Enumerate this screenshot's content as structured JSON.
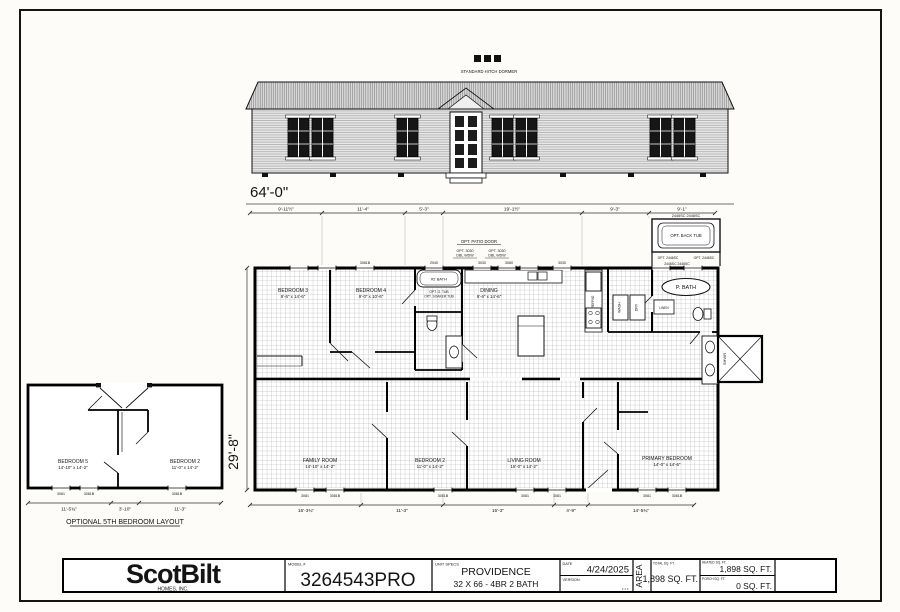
{
  "colors": {
    "paper": "#fdfcf8",
    "ink": "#141414",
    "grid": "#9f9f9f"
  },
  "elevation": {
    "dormer_caption": "STANDARD HITCH DORMER",
    "overall_width": "64'-0\""
  },
  "plan": {
    "overall_depth": "29'-8\"",
    "top_dims": [
      "9'-11½\"",
      "11'-4\"",
      "5'-3\"",
      "19'-1½\"",
      "9'-3\"",
      "9'-1\""
    ],
    "bottom_dims": [
      "15'-3¾\"",
      "11'-3\"",
      "15'-3\"",
      "4'-9\"",
      "14'-5¾\""
    ],
    "rooms": {
      "bedroom3": {
        "name": "BEDROOM 3",
        "size": "9'-6\" x 14'-6\""
      },
      "bedroom4": {
        "name": "BEDROOM 4",
        "size": "9'-0\" x 10'-6\""
      },
      "dining": {
        "name": "DINING",
        "size": "9'-6\" x 14'-6\""
      },
      "family": {
        "name": "FAMILY ROOM",
        "size": "14'-10\" x 14'-2\""
      },
      "bedroom2": {
        "name": "BEDROOM 2",
        "size": "11'-0\" x 14'-2\""
      },
      "living": {
        "name": "LIVING ROOM",
        "size": "15'-0\" x 14'-2\""
      },
      "primary": {
        "name": "PRIMARY BEDROOM",
        "size": "14'-0\" x 14'-6\""
      }
    },
    "fixtures": {
      "bath2": "#2 BATH",
      "opt_tub_1": "OPT. G. TUB",
      "opt_tub_2": "OPT. SOAKER TUB",
      "pbath": "P. BATH",
      "linen": "LINEN",
      "wash": "WASH",
      "dry": "DRY",
      "refrig": "REFRIG",
      "shower": "SHWR"
    },
    "options": {
      "patio_door": "OPT. PATIO DOOR",
      "dbl_wdw_1": "OPT. 3030",
      "dbl_wdw_2": "DBL WDW",
      "back_tub": "OPT. BACK TUB",
      "opt_2446": "OPT. 2446SC"
    },
    "tags": {
      "t2040": "2040",
      "t3030": "3030",
      "t3060": "3060",
      "t3081": "3081",
      "t3081b": "3081B",
      "t2446_pair": "2446SC   2446SC"
    }
  },
  "optional_layout": {
    "caption": "OPTIONAL 5TH BEDROOM LAYOUT",
    "dims": [
      "11'-5¾\"",
      "3'-10\"",
      "11'-3\""
    ],
    "bedroom5": {
      "name": "BEDROOM 5",
      "size": "14'-10\" x 14'-2\""
    },
    "bedroom2": {
      "name": "BEDROOM 2",
      "size": "11'-0\" x 14'-2\""
    }
  },
  "title_block": {
    "logo": "ScotBilt",
    "logo_sub": "HOMES, INC.",
    "model_label": "MODEL #",
    "model": "3264543PRO",
    "specs_label": "UNIT SPECS",
    "specs_line1": "PROVIDENCE",
    "specs_line2": "32 X 66 - 4BR 2 BATH",
    "date_label": "DATE",
    "date": "4/24/2025",
    "version_label": "VERSION",
    "version": "...",
    "area_label": "AREA",
    "total_label": "TOTAL SQ. FT.",
    "total": "1,898 SQ. FT.",
    "heated_label": "HEATED SQ. FT.",
    "heated": "1,898 SQ. FT.",
    "porch_label": "PORCH SQ. FT.",
    "porch": "0 SQ. FT."
  }
}
